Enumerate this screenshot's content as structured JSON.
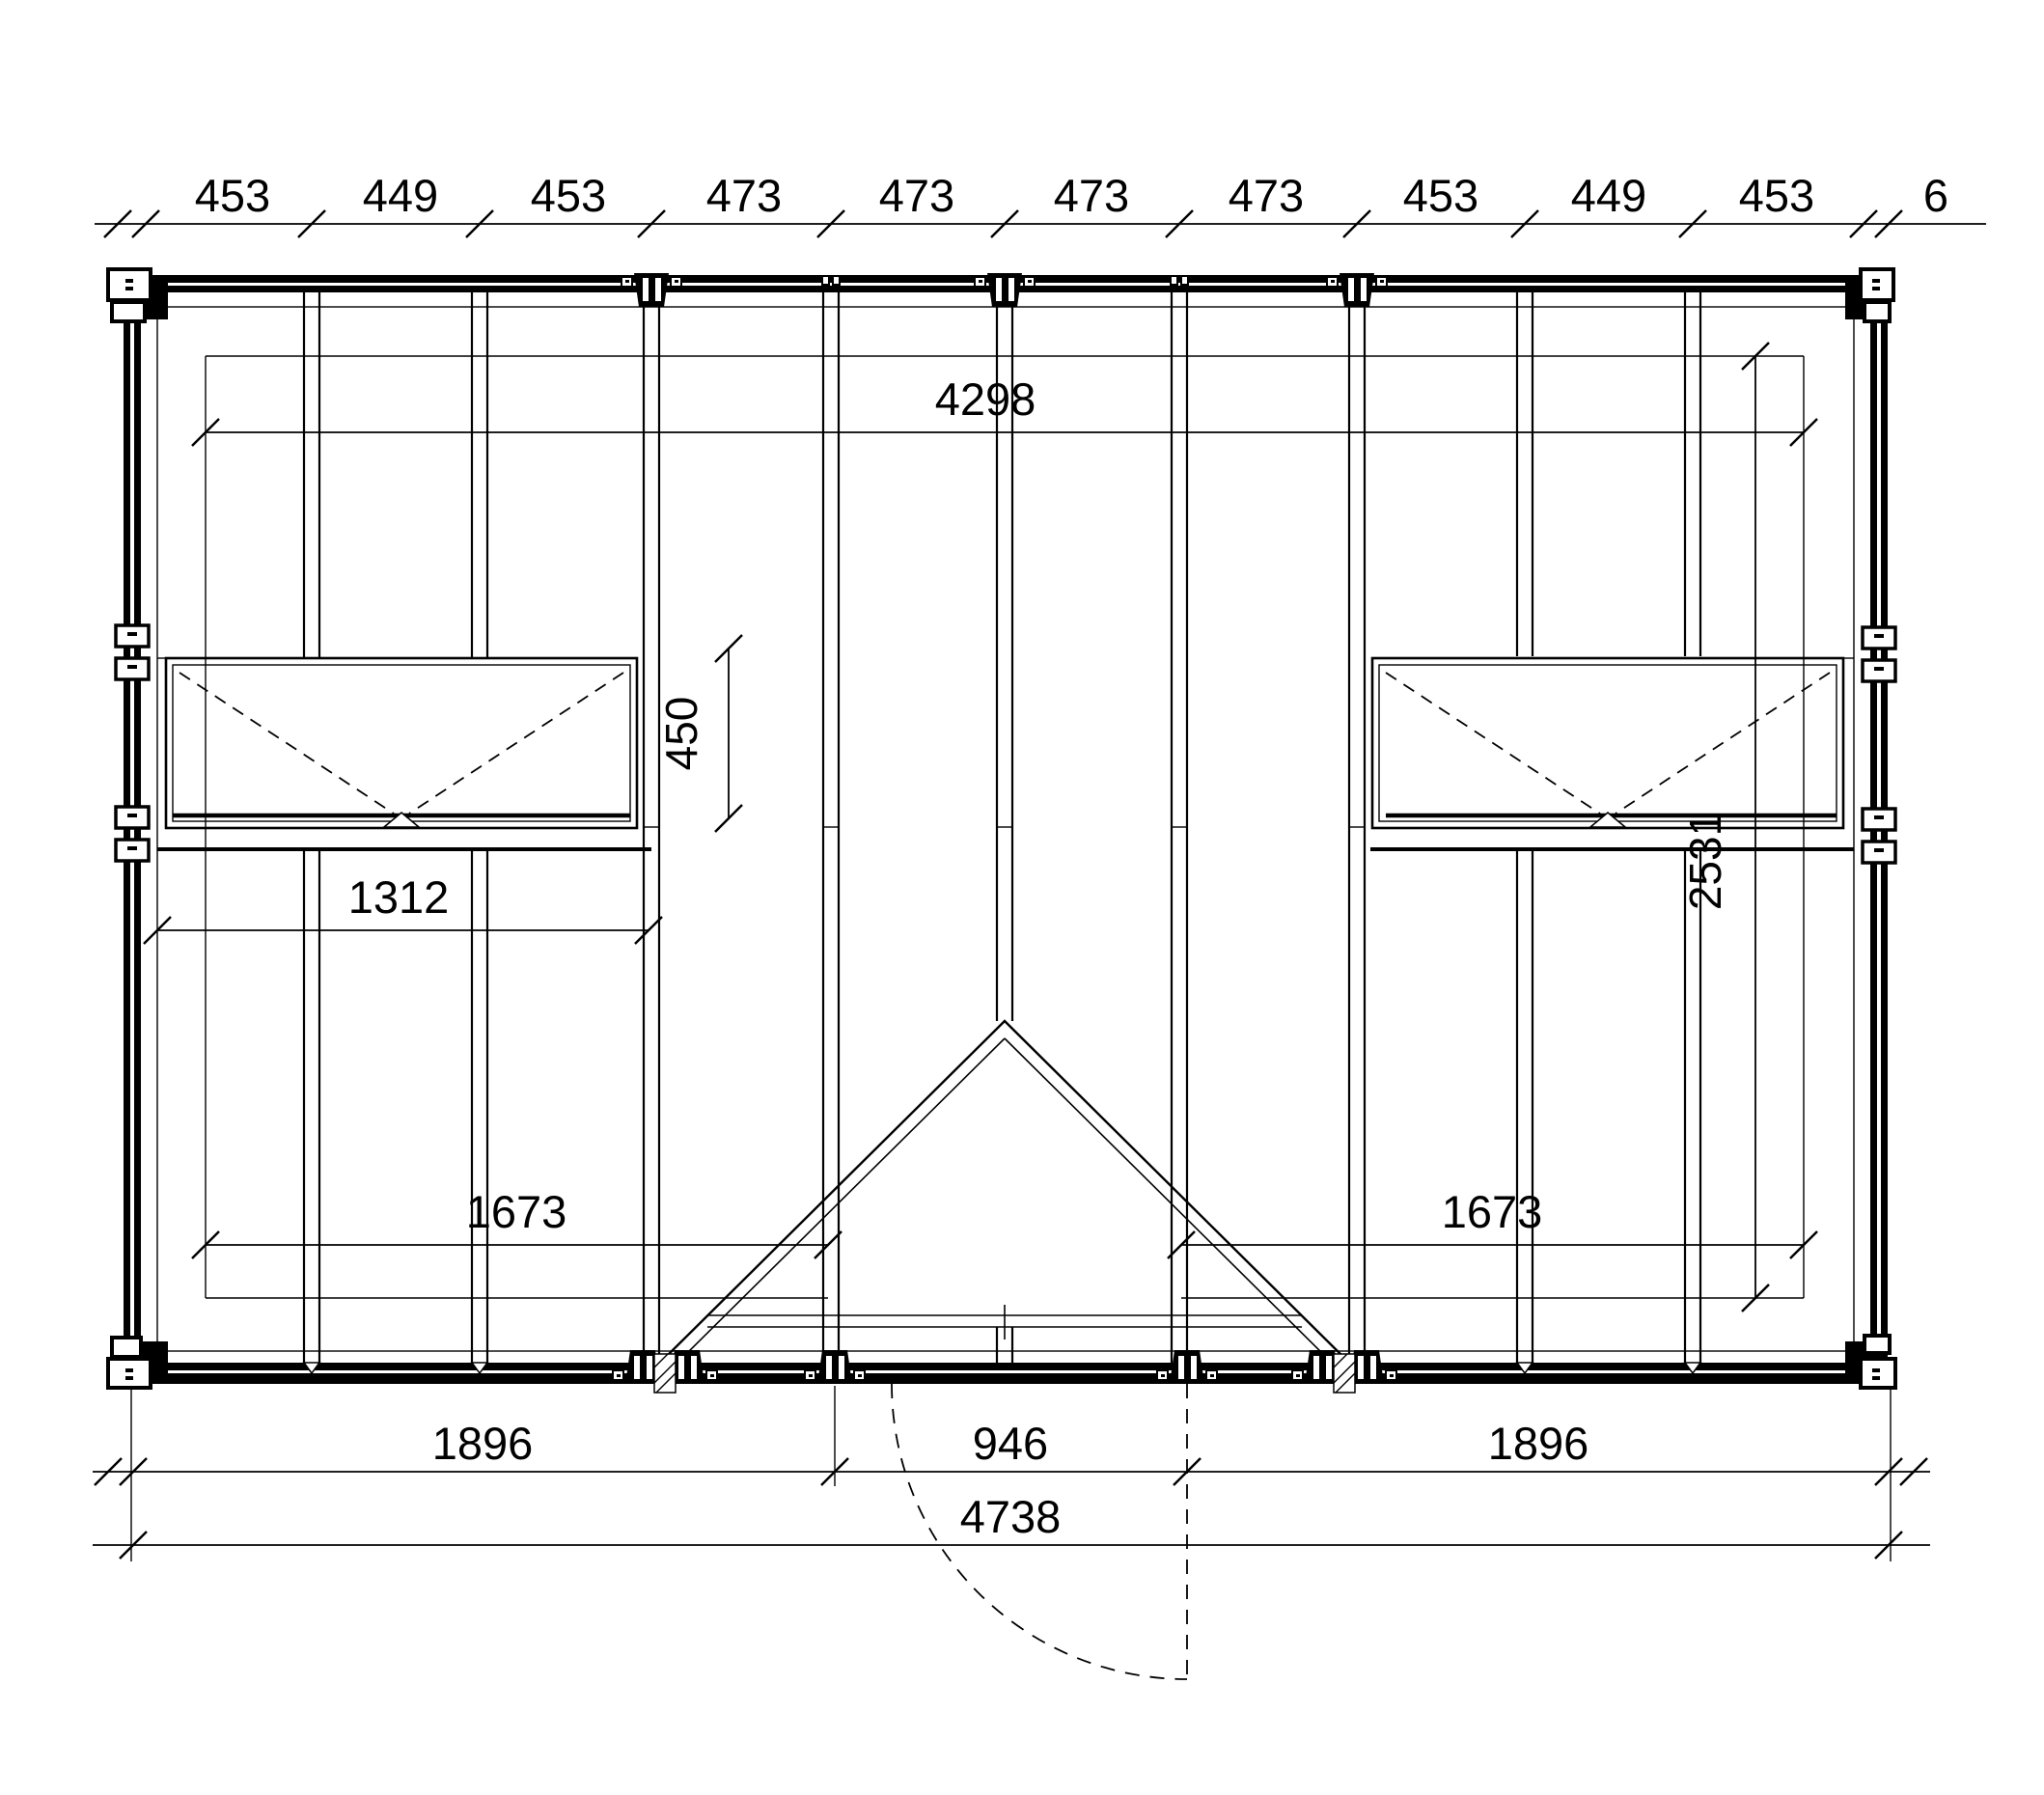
{
  "drawing": {
    "kind": "timber-frame roof framing plan",
    "background_color": "#ffffff",
    "line_color": "#000000"
  },
  "dimensions": {
    "top": [
      "453",
      "449",
      "453",
      "473",
      "473",
      "473",
      "473",
      "453",
      "449",
      "453",
      "6"
    ],
    "panel_width": "4298",
    "window_height": "450",
    "window_width": "1312",
    "panel_depth": "2531",
    "left_span": "1673",
    "right_span": "1673",
    "bottom_left": "1896",
    "door_width": "946",
    "bottom_right": "1896",
    "total_width": "4738"
  }
}
